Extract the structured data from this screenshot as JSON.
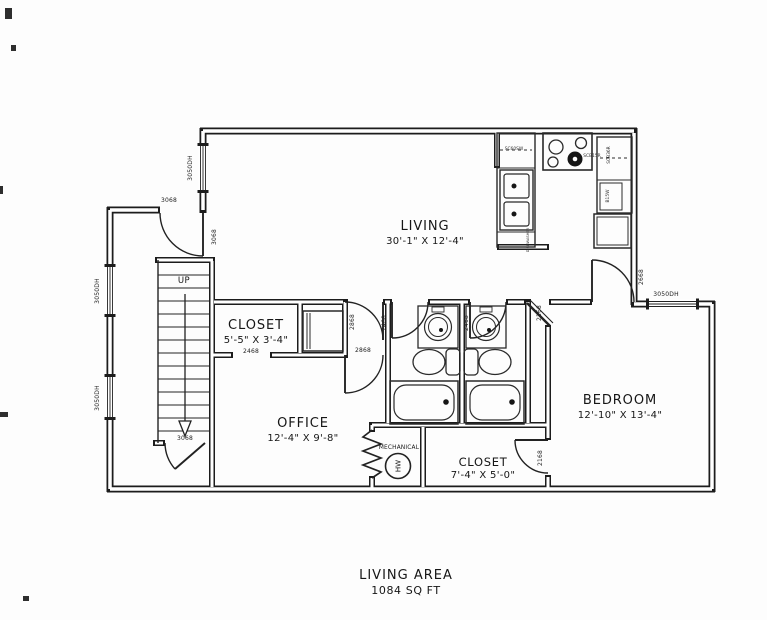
{
  "caption": {
    "line1": "LIVING AREA",
    "line2": "1084 SQ FT"
  },
  "rooms": {
    "living": {
      "name": "LIVING",
      "dims": "30'-1\" X 12'-4\""
    },
    "closet1": {
      "name": "CLOSET",
      "dims": "5'-5\" X 3'-4\""
    },
    "office": {
      "name": "OFFICE",
      "dims": "12'-4\" X 9'-8\""
    },
    "bedroom": {
      "name": "BEDROOM",
      "dims": "12'-10\" X 13'-4\""
    },
    "closet2": {
      "name": "CLOSET",
      "dims": "7'-4\" X 5'-0\""
    },
    "mechanical": {
      "name": "MECHANICAL"
    },
    "stairs": {
      "direction": "UP"
    },
    "water_heater": {
      "label": "HW"
    }
  },
  "openings": {
    "entry_door": "3068",
    "entry_door_swing": "3068",
    "stairs_door": "3068",
    "window_entry": "3050DH",
    "window_left_upper": "3050DH",
    "window_left_lower": "3050DH",
    "window_bedroom": "3050DH",
    "closet1_door": "2468",
    "hall_door": "2868",
    "office_door": "2868",
    "bath1_door": "2468",
    "bath2_door": "2468",
    "bedroom_door": "2668",
    "bedroom_corner_door": "2168",
    "closet2_door": "2168"
  },
  "kitchen": {
    "cabinets": {
      "c1": "SC60SW",
      "c2": "SCB15R",
      "c3": "SCB36R",
      "c4": "B15W",
      "dishwasher": "DISHWASHER"
    }
  }
}
